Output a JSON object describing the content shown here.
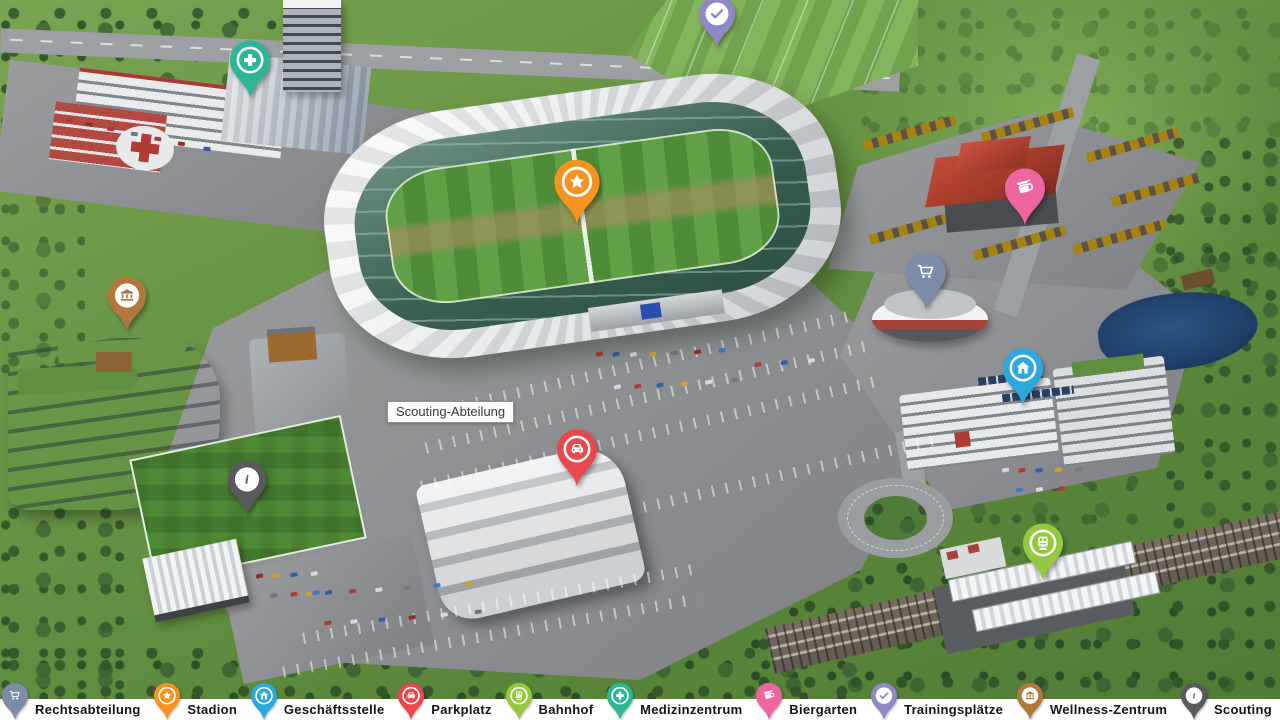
{
  "map": {
    "tooltip": {
      "text": "Scouting-Abteilung"
    },
    "pins": [
      {
        "name": "medizinzentrum",
        "icon": "plus-icon",
        "color": "#2bb795",
        "style": "ring",
        "tip_x": 250,
        "tip_y": 99,
        "w": 46,
        "h": 60
      },
      {
        "name": "trainingsplaetze",
        "icon": "check-icon",
        "color": "#8f88c6",
        "style": "disc",
        "tip_x": 717,
        "tip_y": 49,
        "w": 42,
        "h": 54
      },
      {
        "name": "stadion",
        "icon": "star-icon",
        "color": "#f6921e",
        "style": "ring",
        "tip_x": 577,
        "tip_y": 226,
        "w": 52,
        "h": 68
      },
      {
        "name": "biergarten",
        "icon": "beer-icon",
        "color": "#ed66a0",
        "style": "plain",
        "tip_x": 1025,
        "tip_y": 227,
        "w": 46,
        "h": 60
      },
      {
        "name": "rechtsabteilung",
        "icon": "shopping-cart-icon",
        "color": "#7b8ca6",
        "style": "plain",
        "tip_x": 926,
        "tip_y": 311,
        "w": 46,
        "h": 60
      },
      {
        "name": "wellness-zentrum",
        "icon": "bank-icon",
        "color": "#b2773a",
        "style": "disc",
        "tip_x": 127,
        "tip_y": 333,
        "w": 44,
        "h": 58
      },
      {
        "name": "geschaeftsstelle",
        "icon": "home-icon",
        "color": "#2ba9de",
        "style": "ring",
        "tip_x": 1023,
        "tip_y": 407,
        "w": 46,
        "h": 60
      },
      {
        "name": "parkplatz",
        "icon": "car-icon",
        "color": "#e9494c",
        "style": "ring",
        "tip_x": 577,
        "tip_y": 488,
        "w": 46,
        "h": 60
      },
      {
        "name": "scouting",
        "icon": "info-icon",
        "color": "#595a5c",
        "style": "disc",
        "tip_x": 247,
        "tip_y": 517,
        "w": 44,
        "h": 58
      },
      {
        "name": "bahnhof",
        "icon": "train-icon",
        "color": "#94c93e",
        "style": "ring",
        "tip_x": 1043,
        "tip_y": 582,
        "w": 46,
        "h": 60
      }
    ]
  },
  "legend": {
    "background": "#ffffff",
    "items": [
      {
        "name": "rechtsabteilung",
        "label": "Rechtsabteilung",
        "icon": "shopping-cart-icon",
        "color": "#7b8ca6",
        "style": "plain"
      },
      {
        "name": "stadion",
        "label": "Stadion",
        "icon": "star-icon",
        "color": "#f6921e",
        "style": "ring"
      },
      {
        "name": "geschaeftsstelle",
        "label": "Geschäftsstelle",
        "icon": "home-icon",
        "color": "#2ba9de",
        "style": "ring"
      },
      {
        "name": "parkplatz",
        "label": "Parkplatz",
        "icon": "car-icon",
        "color": "#e9494c",
        "style": "ring"
      },
      {
        "name": "bahnhof",
        "label": "Bahnhof",
        "icon": "train-icon",
        "color": "#94c93e",
        "style": "ring"
      },
      {
        "name": "medizinzentrum",
        "label": "Medizinzentrum",
        "icon": "plus-icon",
        "color": "#2bb795",
        "style": "ring"
      },
      {
        "name": "biergarten",
        "label": "Biergarten",
        "icon": "beer-icon",
        "color": "#ed66a0",
        "style": "plain"
      },
      {
        "name": "trainingsplaetze",
        "label": "Trainingsplätze",
        "icon": "check-icon",
        "color": "#8f88c6",
        "style": "disc"
      },
      {
        "name": "wellness-zentrum",
        "label": "Wellness-Zentrum",
        "icon": "bank-icon",
        "color": "#b2773a",
        "style": "disc"
      },
      {
        "name": "scouting",
        "label": "Scouting",
        "icon": "info-icon",
        "color": "#595a5c",
        "style": "disc"
      }
    ]
  }
}
